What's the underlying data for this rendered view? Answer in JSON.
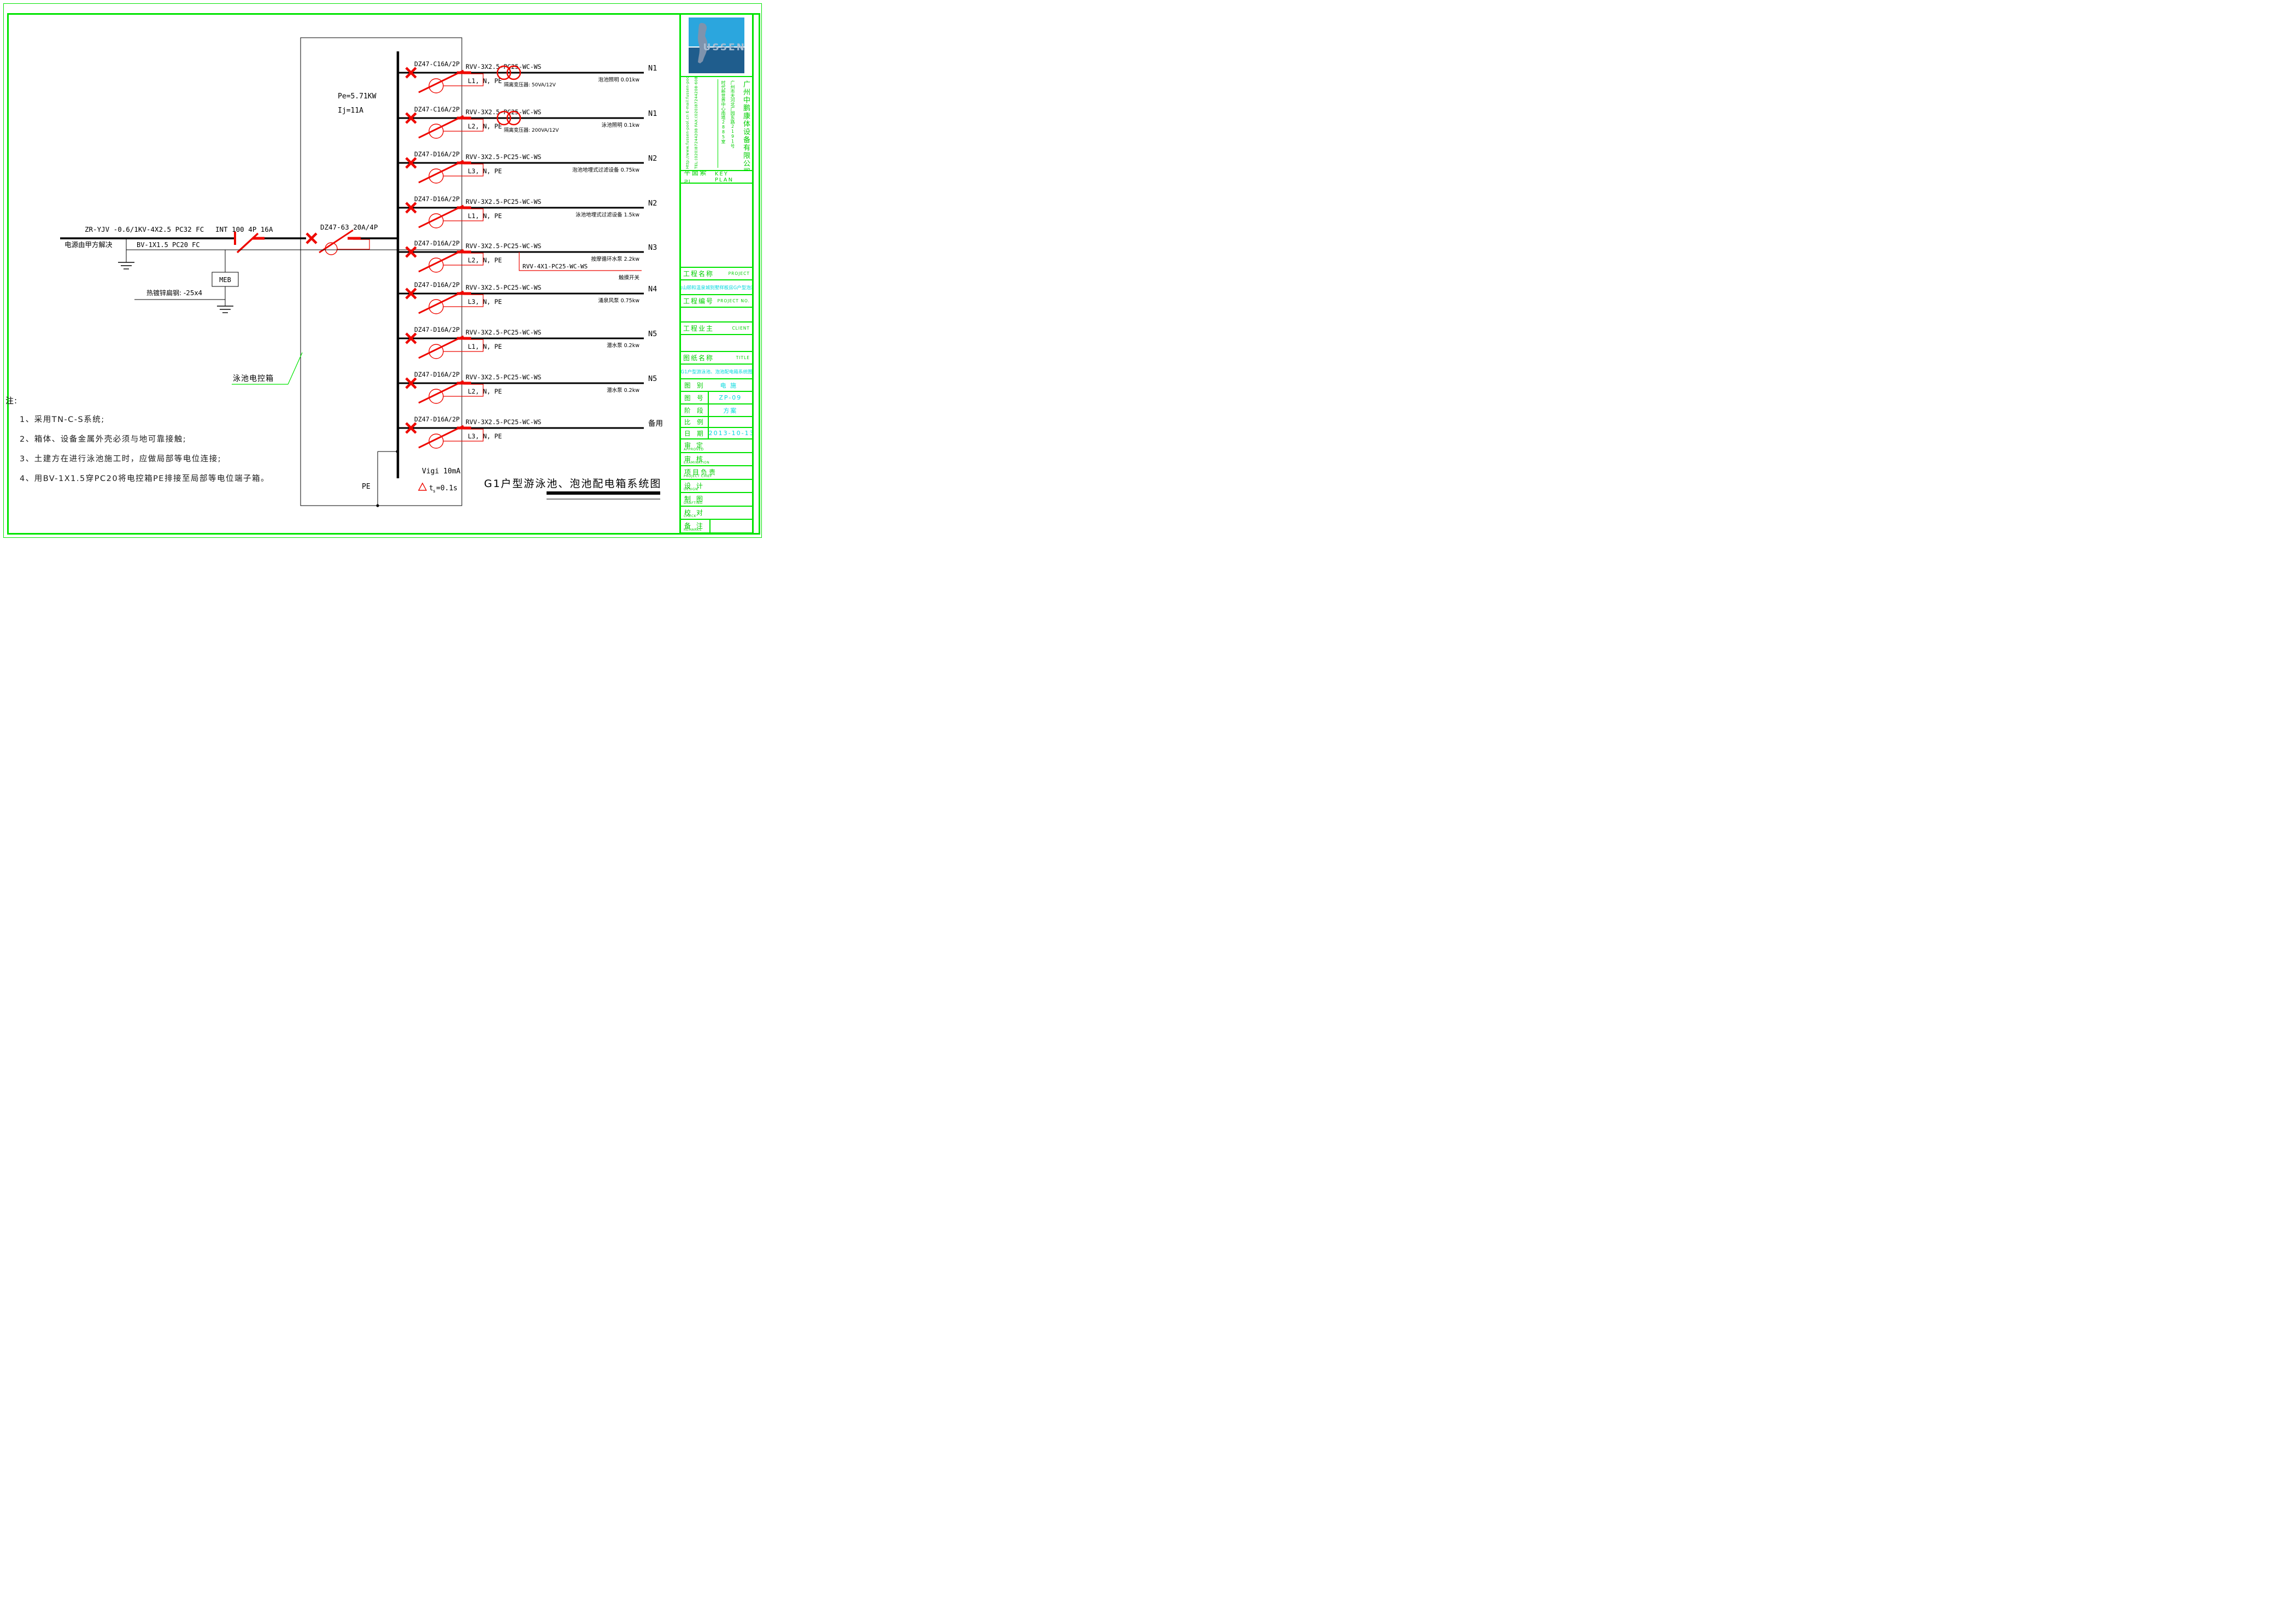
{
  "colors": {
    "border_green": "#00e400",
    "text_green": "#00cf00",
    "value_cyan": "#00d8dd",
    "symbol_red": "#ee0800"
  },
  "incoming": {
    "cable_label": "ZR-YJV -0.6/1KV-4X2.5 PC32  FC",
    "source_note": "电源由甲方解决",
    "isolator_label": "INT 100 4P 16A",
    "pe_cable_label": "BV-1X1.5 PC20 FC",
    "main_breaker_label": "DZ47-63 20A/4P",
    "meb_label": "MEB",
    "earth_strip_label": "热镀锌扁钢: -25x4",
    "power_label": "Pe=5.71KW",
    "current_label": "Ij=11A"
  },
  "panel": {
    "name_label": "泳池电控箱",
    "pe_label": "PE",
    "vigi_label": "Vigi  10mA",
    "trip_t": "t",
    "trip_sub": "s",
    "trip_value": "=0.1s"
  },
  "branches": [
    {
      "breaker": "DZ47-C16A/2P",
      "cable": "RVV-3X2.5-PC25-WC-WS",
      "phases": "L1, N, PE",
      "transformer": "隔离变压器:  50VA/12V",
      "load": "泡池照明",
      "power": "0.01kw",
      "circuit": "N1"
    },
    {
      "breaker": "DZ47-C16A/2P",
      "cable": "RVV-3X2.5-PC25-WC-WS",
      "phases": "L2, N, PE",
      "transformer": "隔离变压器:  200VA/12V",
      "load": "泳池照明",
      "power": "0.1kw",
      "circuit": "N1"
    },
    {
      "breaker": "DZ47-D16A/2P",
      "cable": "RVV-3X2.5-PC25-WC-WS",
      "phases": "L3, N, PE",
      "load": "泡池地埋式过滤设备",
      "power": "0.75kw",
      "circuit": "N2"
    },
    {
      "breaker": "DZ47-D16A/2P",
      "cable": "RVV-3X2.5-PC25-WC-WS",
      "phases": "L1, N, PE",
      "load": "泳池地埋式过滤设备",
      "power": "1.5kw",
      "circuit": "N2"
    },
    {
      "breaker": "DZ47-D16A/2P",
      "cable": "RVV-3X2.5-PC25-WC-WS",
      "phases": "L2, N, PE",
      "load": "按摩循环水泵",
      "power": "2.2kw",
      "circuit": "N3",
      "aux_cable": "RVV-4X1-PC25-WC-WS",
      "aux_load": "触摸开关"
    },
    {
      "breaker": "DZ47-D16A/2P",
      "cable": "RVV-3X2.5-PC25-WC-WS",
      "phases": "L3, N, PE",
      "load": "涌泉风泵",
      "power": "0.75kw",
      "circuit": "N4"
    },
    {
      "breaker": "DZ47-D16A/2P",
      "cable": "RVV-3X2.5-PC25-WC-WS",
      "phases": "L1, N, PE",
      "load": "潜水泵",
      "power": "0.2kw",
      "circuit": "N5"
    },
    {
      "breaker": "DZ47-D16A/2P",
      "cable": "RVV-3X2.5-PC25-WC-WS",
      "phases": "L2, N, PE",
      "load": "潜水泵",
      "power": "0.2kw",
      "circuit": "N5"
    },
    {
      "breaker": "DZ47-D16A/2P",
      "cable": "RVV-3X2.5-PC25-WC-WS",
      "phases": "L3, N, PE",
      "circuit": "备用"
    }
  ],
  "footer": {
    "diagram_title": "G1户型游泳池、泡池配电箱系统图"
  },
  "notes": {
    "heading": "注:",
    "items": [
      "1、采用TN-C-S系统;",
      "2、箱体、设备金属外壳必须与地可靠接触;",
      "3、土建方在进行泳池施工时，应做局部等电位连接;",
      "4、用BV-1X1.5穿PC20将电控箱PE排接至局部等电位端子箱。"
    ]
  },
  "title_block": {
    "logo_text": "USSEN",
    "company_name": "广州中鹏康体设备有限公司",
    "address_line1": "广州市天河北广园东路2191号",
    "address_line2": "时代新世界中心南塔2885室",
    "contact_line1": "Http://www.fussen-pool.cn    E-mail:fussen-pool@126.com",
    "contact_line2": "TEL:(020)87244208   FAX:(020)87244208-608   P.C:510500",
    "key_plan_cn": "平面索引",
    "key_plan_en": "KEY PLAN",
    "project_cn": "工程名称",
    "project_en": "PROJECT",
    "project_value": "台山颐和温泉城别墅样板房G户型泡池",
    "project_no_cn": "工程编号",
    "project_no_en": "PROJECT NO.",
    "client_cn": "工程业主",
    "client_en": "CLIENT",
    "sheet_cn": "图纸名称",
    "sheet_en": "TITLE",
    "sheet_value": "G1户型游泳池、泡池配电箱系统图",
    "fields": [
      {
        "label": "图  别",
        "value": "电  施",
        "div": false
      },
      {
        "label": "图  号",
        "value": "ZP-09",
        "div": true
      },
      {
        "label": "阶  段",
        "value": "方案",
        "div": true
      },
      {
        "label": "比  例",
        "value": "",
        "div": true
      },
      {
        "label": "日  期",
        "value": "2013-10-13",
        "div": true
      }
    ],
    "sign_rows": [
      {
        "cn": "审  定",
        "en": "APPROVED",
        "div": false
      },
      {
        "cn": "审  核",
        "en": "EXAMINATION",
        "div": false
      },
      {
        "cn": "项目负责",
        "en": "PROJECT CHIEF",
        "div": false
      },
      {
        "cn": "设  计",
        "en": "DESIGN",
        "div": false
      },
      {
        "cn": "制  图",
        "en": "DRAFTING",
        "div": false
      },
      {
        "cn": "校  对",
        "en": "CHECK",
        "div": false
      },
      {
        "cn": "备  注",
        "en": "REMARKS",
        "div": true
      }
    ]
  }
}
